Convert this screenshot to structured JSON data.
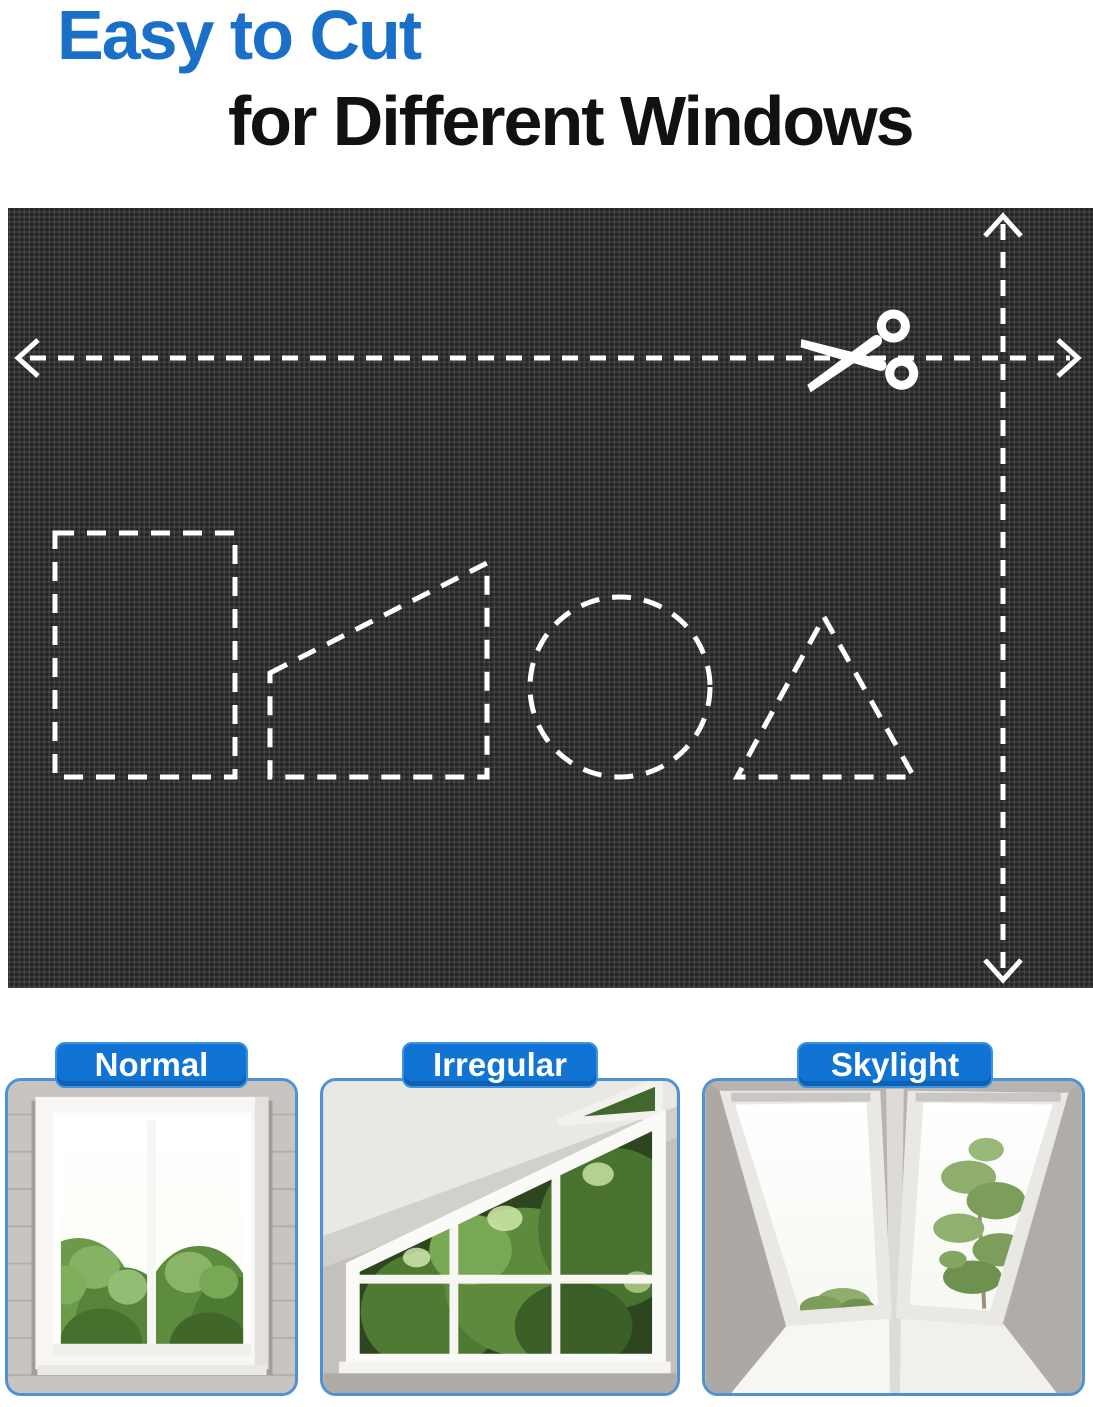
{
  "title": {
    "line1": "Easy to Cut",
    "line2": "for Different Windows"
  },
  "fabric_panel": {
    "icons": {
      "scissors-icon": "✂",
      "horizontal-cut-arrow": "↔ dashed",
      "vertical-cut-arrow": "↕ dashed"
    },
    "cut_guide_shapes": [
      "rectangle",
      "trapezoid",
      "circle",
      "triangle"
    ]
  },
  "examples": [
    {
      "label": "Normal"
    },
    {
      "label": "Irregular"
    },
    {
      "label": "Skylight"
    }
  ],
  "colors": {
    "title_blue": "#1a6fc8",
    "title_black": "#111111",
    "badge_blue": "#1173d3",
    "badge_rim": "#3e93e0",
    "card_border": "#4e92d6",
    "fabric_base": "#262626",
    "dash_white": "#ffffff",
    "foliage_green": "#5d8a3d"
  }
}
